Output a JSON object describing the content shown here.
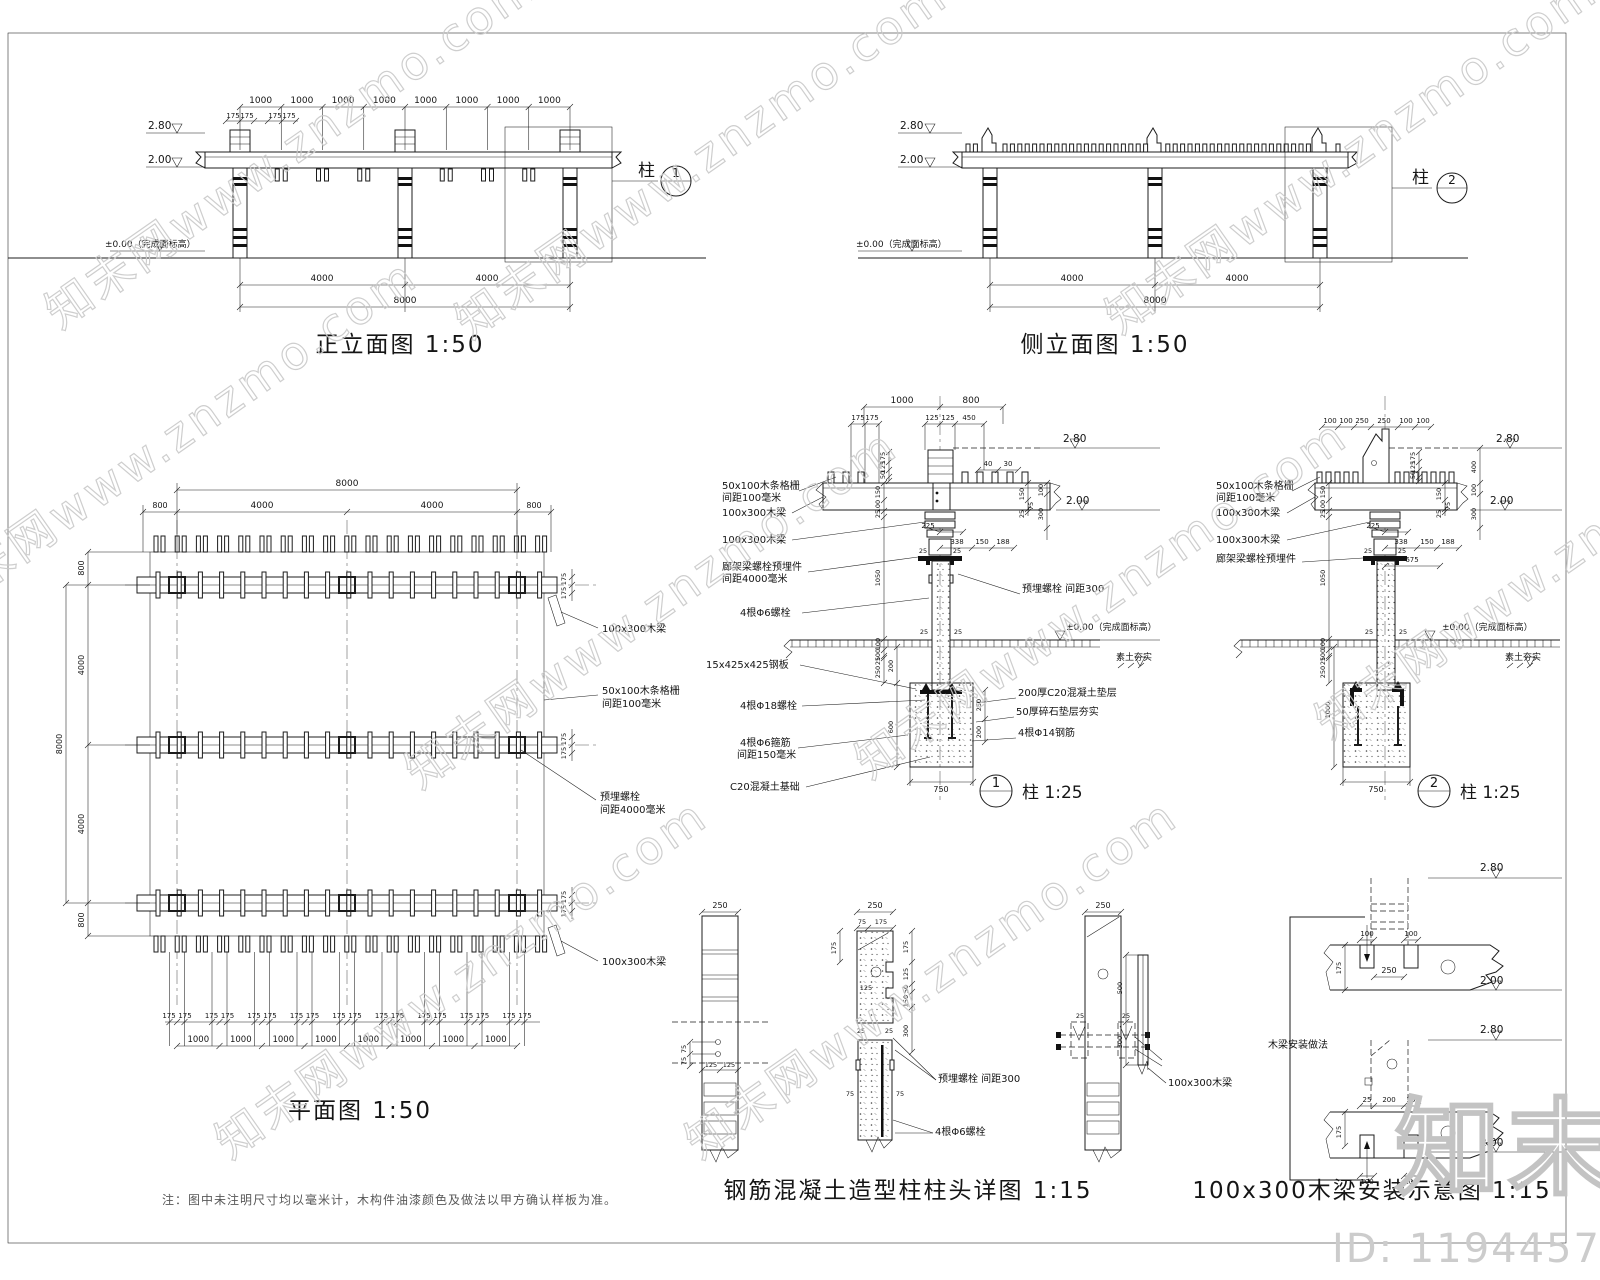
{
  "watermark": {
    "tile": "知末网www.znzmo.com",
    "logo": "知末",
    "id_label": "ID: 1194457426"
  },
  "front": {
    "title": "正立面图 1:50",
    "dims_top": [
      "1000",
      "1000",
      "1000",
      "1000",
      "1000",
      "1000",
      "1000",
      "1000"
    ],
    "dims_175": [
      "175",
      "175",
      "175",
      "175"
    ],
    "dim_4000a": "4000",
    "dim_4000b": "4000",
    "dim_8000": "8000",
    "lvl_280": "2.80",
    "lvl_200": "2.00",
    "lvl_000": "±0.00（完成面标高）",
    "callout_num": "1",
    "callout_label": "柱"
  },
  "side": {
    "title": "侧立面图 1:50",
    "dim_4000a": "4000",
    "dim_4000b": "4000",
    "dim_8000": "8000",
    "lvl_280": "2.80",
    "lvl_200": "2.00",
    "lvl_000": "±0.00（完成面标高）",
    "callout_num": "2",
    "callout_label": "柱"
  },
  "plan": {
    "title": "平面图 1:50",
    "dim_top_8000": "8000",
    "dims_top": [
      "800",
      "4000",
      "4000",
      "800"
    ],
    "dims_left": [
      "800",
      "4000",
      "4000",
      "800"
    ],
    "dim_left_8000": "8000",
    "rows_175": [
      "175",
      "175",
      "175",
      "175",
      "175",
      "175"
    ],
    "dims_bot_175L": [
      "175",
      "175",
      "175",
      "175",
      "175",
      "175",
      "175",
      "175",
      "175"
    ],
    "dims_bot_175R": [
      "175",
      "175",
      "175",
      "175",
      "175",
      "175",
      "175",
      "175",
      "175"
    ],
    "dims_bot_1000": [
      "1000",
      "1000",
      "1000",
      "1000",
      "1000",
      "1000",
      "1000",
      "1000"
    ],
    "lbl_beam_top": "100x300木梁",
    "lbl_slat1": "50x100木条格栅",
    "lbl_slat2": "间距100毫米",
    "lbl_bolt1": "预埋螺栓",
    "lbl_bolt2": "间距4000毫米",
    "lbl_beam_bot": "100x300木梁",
    "note": "注：图中未注明尺寸均以毫米计，木构件油漆颜色及做法以甲方确认样板为准。"
  },
  "d1": {
    "callout_num": "1",
    "callout_label": "柱 1:25",
    "top_1000": "1000",
    "top_800": "800",
    "p175a": "175",
    "p175b": "175",
    "p125a": "125",
    "p125b": "125",
    "d450": "450",
    "d40": "40",
    "d30": "30",
    "cap_chain": [
      "175",
      "125",
      "50"
    ],
    "rv_150": "150",
    "rv_75": "75",
    "rv_25": "25",
    "rv_100": "100",
    "rv_300": "300",
    "d225": "225",
    "d338": "338",
    "d150": "150",
    "d188": "188",
    "n25": [
      "25",
      "25",
      "25",
      "25"
    ],
    "lc": [
      "150",
      "100",
      "25",
      "1050",
      "100",
      "100",
      "25",
      "250"
    ],
    "f_200": "200",
    "f_600": "600",
    "f_250": "250",
    "f_200b": "200",
    "f_750": "750",
    "lvl_280": "2.80",
    "lvl_200": "2.00",
    "lvl_000": "±0.00（完成面标高）",
    "lvl_soil": "素土夯实",
    "ll": [
      "50x100木条格栅",
      "间距100毫米",
      "100x300木梁",
      "100x300木梁",
      "廊架梁螺栓预埋件",
      "间距4000毫米",
      "4根Φ6螺栓",
      "15x425x425钢板",
      "4根Φ18螺栓",
      "4根Φ6箍筋",
      "间距150毫米",
      "C20混凝土基础"
    ],
    "rl": [
      "预埋螺栓 间距300",
      "200厚C20混凝土垫层",
      "50厚碎石垫层夯实",
      "4根Φ14钢筋"
    ]
  },
  "d2": {
    "callout_num": "2",
    "callout_label": "柱 1:25",
    "top_row": [
      "100",
      "100",
      "250",
      "250",
      "100",
      "100"
    ],
    "cap_chain": [
      "175",
      "125",
      "50"
    ],
    "rv_150": "150",
    "rv_75": "75",
    "rv_25": "25",
    "rv_400": "400",
    "rv_100": "100",
    "rv_300": "300",
    "d225": "225",
    "d338": "338",
    "d150": "150",
    "d188": "188",
    "d675": "675",
    "n25": [
      "25",
      "25",
      "25",
      "25"
    ],
    "lc": [
      "150",
      "100",
      "25",
      "1050",
      "100",
      "100",
      "25",
      "250"
    ],
    "f_1000": "1000",
    "f_750": "750",
    "lvl_280": "2.80",
    "lvl_200": "2.00",
    "lvl_000": "±0.00（完成面标高）",
    "lvl_soil": "素土夯实",
    "ll": [
      "50x100木条格栅",
      "间距100毫米",
      "100x300木梁",
      "100x300木梁",
      "廊架梁螺栓预埋件"
    ]
  },
  "ch": {
    "title": "钢筋混凝土造型柱柱头详图 1:15",
    "a_250": "250",
    "a_75a": "75",
    "a_75b": "75",
    "a_125a": "125",
    "a_125b": "125",
    "b_250": "250",
    "b_75": "75",
    "b_175": "175",
    "b_l175": "175",
    "b_hole": "125",
    "b_chain": [
      "175",
      "125",
      "50",
      "150",
      "300"
    ],
    "b_25a": "25",
    "b_25b": "25",
    "b_s75a": "75",
    "b_s75b": "75",
    "c_250": "250",
    "c_25a": "25",
    "c_25b": "25",
    "lbl_bolt": "预埋螺栓 间距300",
    "lbl_anchor": "4根Φ6螺栓"
  },
  "bi": {
    "title": "100x300木梁安装示意图 1:15",
    "lbl_beam": "100x300木梁",
    "lbl_note": "木梁安装做法",
    "sd_500": "500",
    "sd_300": "300",
    "u_280": "2.80",
    "u_200": "2.00",
    "u_100a": "100",
    "u_100b": "100",
    "u_250": "250",
    "u_175": "175",
    "l_280": "2.80",
    "l_200": "2.00",
    "l_25a": "25",
    "l_200d": "200",
    "l_25b": "25",
    "l_175": "175",
    "l_100a": "100",
    "l_100b": "100"
  }
}
